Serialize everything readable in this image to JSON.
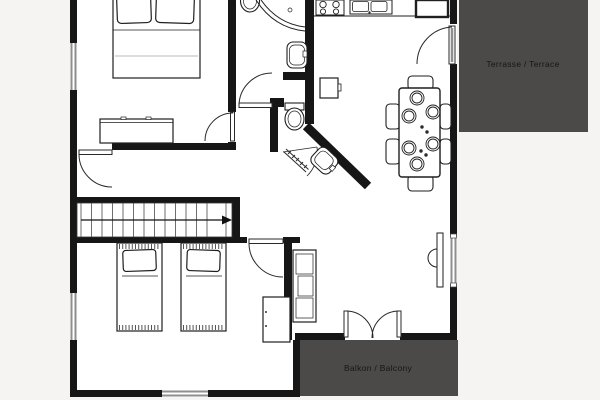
{
  "plan": {
    "labels": {
      "terrace": "Terrasse / Terrace",
      "balcony": "Balkon / Balcony"
    },
    "colors": {
      "background": "#f5f4f2",
      "floor": "#ffffff",
      "wall": "#161616",
      "outdoor_area": "#4b4a48",
      "window": "#8e8e8e",
      "furniture_line": "#1f1f1f",
      "label_text": "#161616"
    },
    "rooms": [
      "bedroom-top",
      "bathroom",
      "wc",
      "hallway",
      "staircase",
      "bedroom-bottom",
      "kitchen-living-dining"
    ],
    "outdoor_areas": [
      "terrace",
      "balcony"
    ],
    "furniture": [
      "double-bed",
      "dresser",
      "stairs",
      "single-bed-left",
      "single-bed-right",
      "wardrobe",
      "shower",
      "toilet",
      "washbasin",
      "wc-toilet",
      "corner-washbasin",
      "side-table",
      "stove",
      "kitchen-sink",
      "tall-cabinet",
      "dining-table",
      "dining-chairs",
      "place-settings",
      "radiator",
      "sideboard"
    ]
  }
}
